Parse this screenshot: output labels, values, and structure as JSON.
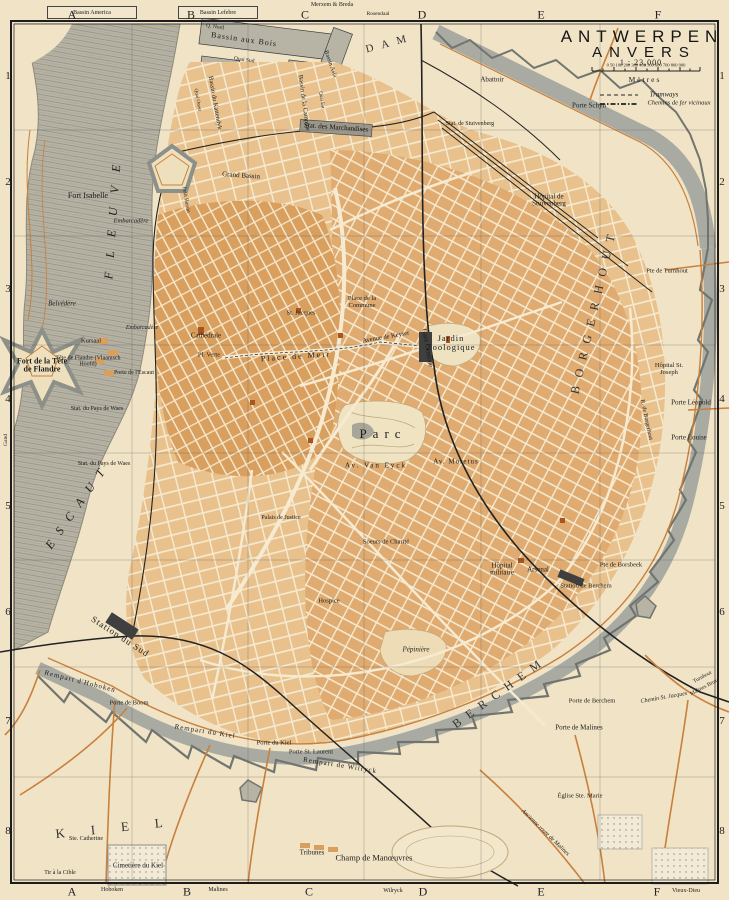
{
  "title": {
    "name": "ANTWERPEN",
    "name_fr": "ANVERS",
    "scale": "1 : 23,000"
  },
  "scale_bar": {
    "ticks": "0 50 100  200  300  400  500  600  700  800  900",
    "unit": "Mètres"
  },
  "legend": {
    "tramways": "Tramways",
    "vicinaux": "Chemins de fer vicinaux"
  },
  "grid": {
    "cols": [
      "A",
      "B",
      "C",
      "D",
      "E",
      "F"
    ],
    "rows": [
      "1",
      "2",
      "3",
      "4",
      "5",
      "6",
      "7",
      "8"
    ]
  },
  "edges": {
    "box_america": "Bassin America",
    "box_lefebre": "Bassin Lefebre",
    "top_center": "Merxem & Breda",
    "top_d": "Rosendaal",
    "bottom_a": "Hoboken",
    "bottom_b": "Malines",
    "bottom_d": "Wilryck",
    "bottom_f": "Vieux-Dieu",
    "left_gand": "Gand"
  },
  "colors": {
    "paper": "#f1e3c6",
    "water": "#b7b3a5",
    "block_dark": "#d99f5e",
    "block_mid": "#e0ab70",
    "block_light": "#e8c18c",
    "wall": "#a9aba3",
    "road": "#c8803c",
    "rail": "#222222"
  },
  "labels": {
    "river_fleuve": "FLEUVE",
    "river_escaut": "ESCAUT",
    "fort_isabelle": "Fort Isabelle",
    "embarcadere_n": "Embarcadère",
    "embarcadere_s": "Embarcadère",
    "belvedere": "Belvédère",
    "kursaal": "Kursaal",
    "tete_flandre": "Tête de Flandre (Vlaamsch Hoofd)",
    "fort_tete": "Fort de la Tête de Flandre",
    "porte_escaut": "Porte de l'Escaut",
    "stat_waes_n": "Stat. du Pays de Waes",
    "stat_waes_s": "Stat. du Pays de Waes",
    "station_sud": "Station du Sud",
    "q_nord": "Q. Nord",
    "quai_sud": "Quai Sud",
    "quai_est": "Quai Est",
    "quai_ouest": "Quai Ouest",
    "bassin_aux_bois": "Bassin aux Bois",
    "bassin_campine": "Bassin de la Campine",
    "bassin_asia": "Bassin Asia",
    "bassin_kattendyk": "Bassin du Kattendyk",
    "grand_bassin": "Grand Bassin",
    "petit_bassin": "Petit Bassin",
    "stat_marchandises": "Stat. des Marchandises",
    "dam": "DAM",
    "abattoir": "Abattoir",
    "porte_schyn": "Porte Schyn",
    "stat_stuivenberg": "Stat. de Stuivenberg",
    "hopital_stuivenberg": "Hôpital de Stuivenberg",
    "cathedrale": "Cathédrale",
    "pl_verte": "Pl. Verte",
    "place_meir": "Place de Meir",
    "st_jacques": "St. Jacques",
    "place_commune": "Place de la Commune",
    "av_keyser": "Avenue de Keyser",
    "gare_centrale": "Gare Centrale",
    "jardin_zoologique": "Jardin Zoologique",
    "parc": "Parc",
    "av_van_eyck": "Av. Van Eyck",
    "av_moretus": "Av. Moretus",
    "borgerhout": "BORGERHOUT",
    "porte_turnhout": "Pte de Turnhout",
    "hopital_st_joseph": "Hôpital St. Joseph",
    "porte_leopold": "Porte Léopold",
    "porte_louise": "Porte Louise",
    "rue_borgerhout": "R. de Borgerhout",
    "soeurs_charite": "Soeurs de Charité",
    "palais_justice": "Palais de Justice",
    "hospice": "Hospice",
    "hopital_militaire": "Hôpital militaire",
    "arsenal": "Arsenal",
    "station_berchem": "Station de Berchem",
    "porte_borsbeek": "Pte de Borsbeek",
    "pepiniere": "Pépinière",
    "berchem": "BERCHEM",
    "porte_berchem": "Porte de Berchem",
    "porte_malines": "Porte de Malines",
    "chemin_st_jacques": "Chemin St. Jacques",
    "rail_turnhout": "Turnhout",
    "rail_malines": "Malines Brux.",
    "ancienne_route": "Ancienne route de Malines",
    "eglise_ste_marie": "Église Ste. Marie",
    "rempart_wilryck": "Rempart de Wilryck",
    "porte_st_laurent": "Porte St. Laurent",
    "porte_kiel": "Porte du Kiel",
    "rempart_kiel": "Rempart du Kiel",
    "porte_boom": "Porte de Boom",
    "rempart_hoboken": "Rempart d'Hoboken",
    "kiel": "KIEL",
    "ste_catherine": "Ste. Catherine",
    "cimetiere_kiel": "Cimetière du Kiel",
    "tir_cible": "Tir à la Cible",
    "tribunes": "Tribunes",
    "champ_manoeuvres": "Champ de Manœuvres"
  }
}
